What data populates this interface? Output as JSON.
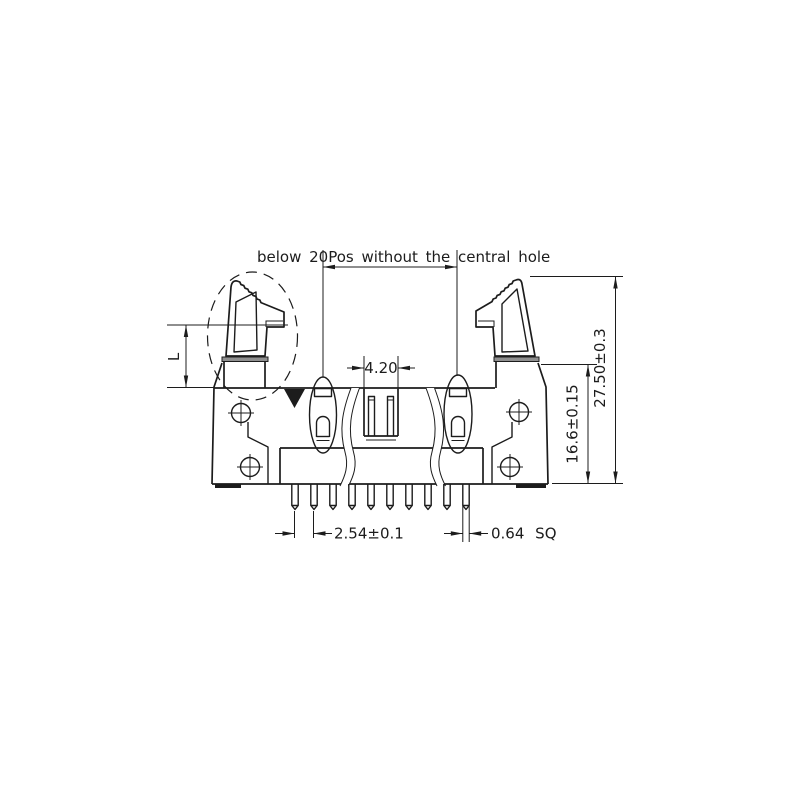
{
  "drawing": {
    "title_note": "below 20Pos without the central hole",
    "dimensions": {
      "key_slot_width": "4.20",
      "pin_pitch": "2.54±0.1",
      "pin_square": "0.64 SQ",
      "insulator_height": "16.6±0.15",
      "overall_height": "27.50±0.3",
      "latch_height_label": "L"
    },
    "pin_count_visible": 10,
    "colors": {
      "line": "#1c1c1c",
      "background": "#ffffff"
    }
  }
}
